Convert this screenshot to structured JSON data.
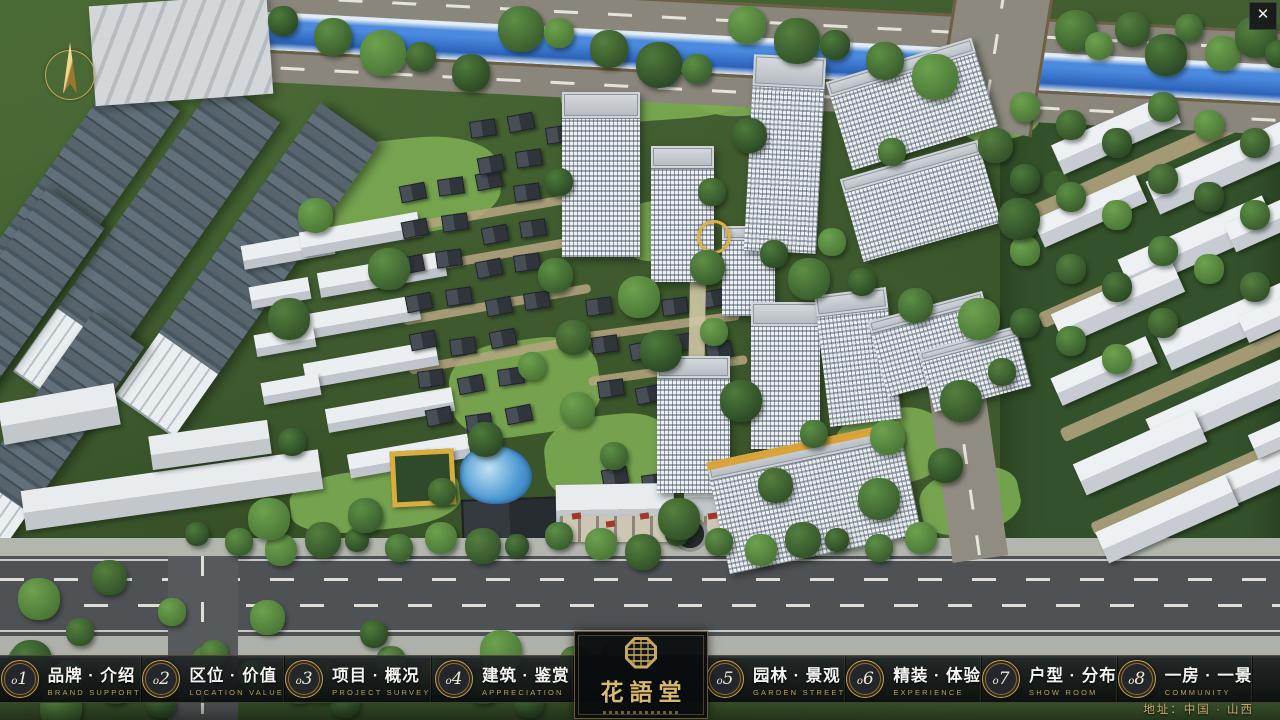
{
  "window": {
    "close_icon": "✕"
  },
  "logo": {
    "title": "花語堂"
  },
  "nav": {
    "items": [
      {
        "num": "o1",
        "label_zh": "品牌 · 介绍",
        "label_en": "BRAND SUPPORT"
      },
      {
        "num": "o2",
        "label_zh": "区位 · 价值",
        "label_en": "LOCATION VALUE"
      },
      {
        "num": "o3",
        "label_zh": "项目 · 概况",
        "label_en": "PROJECT SURVEY"
      },
      {
        "num": "o4",
        "label_zh": "建筑 · 鉴赏",
        "label_en": "APPRECIATION"
      },
      {
        "num": "o5",
        "label_zh": "园林 · 景观",
        "label_en": "GARDEN STREET"
      },
      {
        "num": "o6",
        "label_zh": "精装 · 体验",
        "label_en": "EXPERIENCE"
      },
      {
        "num": "o7",
        "label_zh": "户型 · 分布",
        "label_en": "SHOW ROOM"
      },
      {
        "num": "o8",
        "label_zh": "一房 · 一景",
        "label_en": "COMMUNITY"
      }
    ]
  },
  "footer": {
    "address": "地址：中国 · 山西"
  },
  "colors": {
    "gold": "#c2a05e",
    "bar_bg": "rgba(10,12,15,0.88)",
    "river": "#2f6fce",
    "grass": "#7cab52"
  }
}
